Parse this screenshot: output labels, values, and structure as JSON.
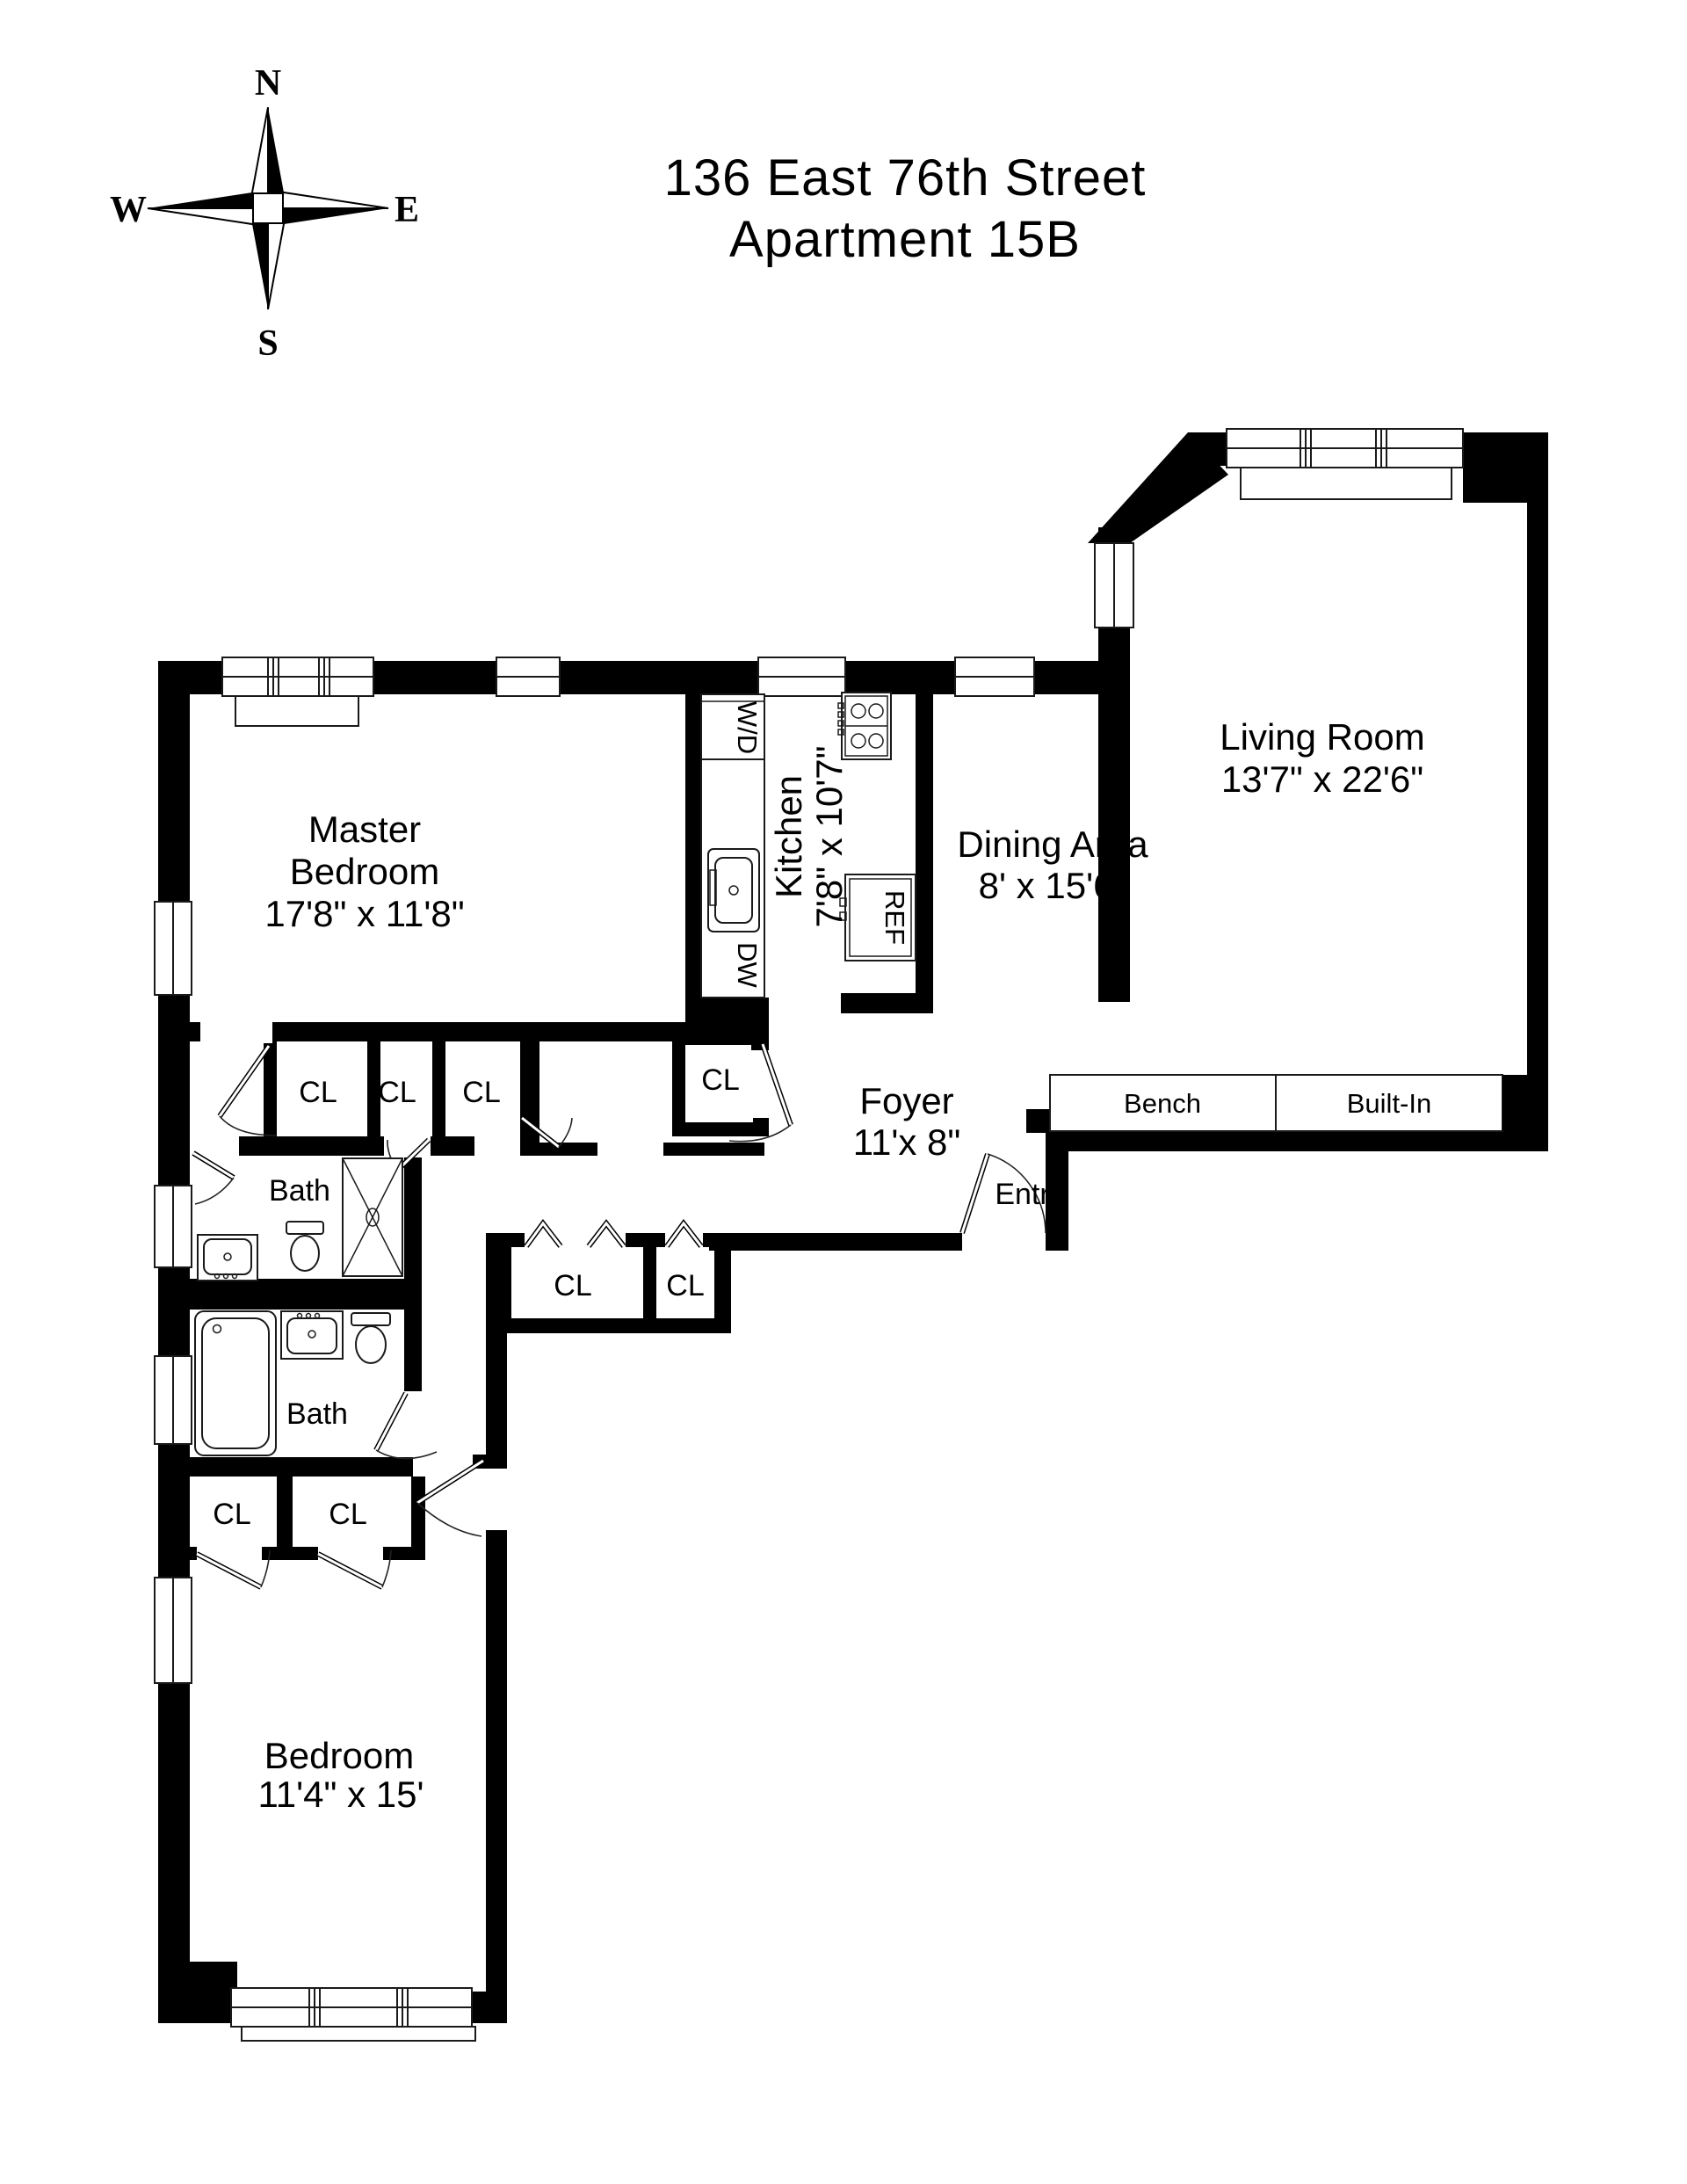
{
  "title": {
    "line1": "136 East 76th Street",
    "line2": "Apartment 15B"
  },
  "compass": {
    "north": "N",
    "south": "S",
    "east": "E",
    "west": "W"
  },
  "rooms": {
    "living": {
      "name": "Living Room",
      "dims": "13'7\" x 22'6\""
    },
    "dining": {
      "name": "Dining Area",
      "dims": "8' x 15'6\""
    },
    "kitchen": {
      "name": "Kitchen",
      "dims": "7'8\" x 10'7\""
    },
    "master": {
      "name1": "Master",
      "name2": "Bedroom",
      "dims": "17'8\" x 11'8\""
    },
    "bedroom": {
      "name": "Bedroom",
      "dims": "11'4\" x 15'"
    },
    "foyer": {
      "name": "Foyer",
      "dims": "11'x 8\""
    },
    "bath_upper": {
      "name": "Bath"
    },
    "bath_lower": {
      "name": "Bath"
    },
    "entry": {
      "name": "Entry"
    }
  },
  "fixtures": {
    "washer_dryer": "W/D",
    "dishwasher": "DW",
    "refrigerator": "REF",
    "bench": "Bench",
    "built_in": "Built-In"
  },
  "closet_label": "CL"
}
